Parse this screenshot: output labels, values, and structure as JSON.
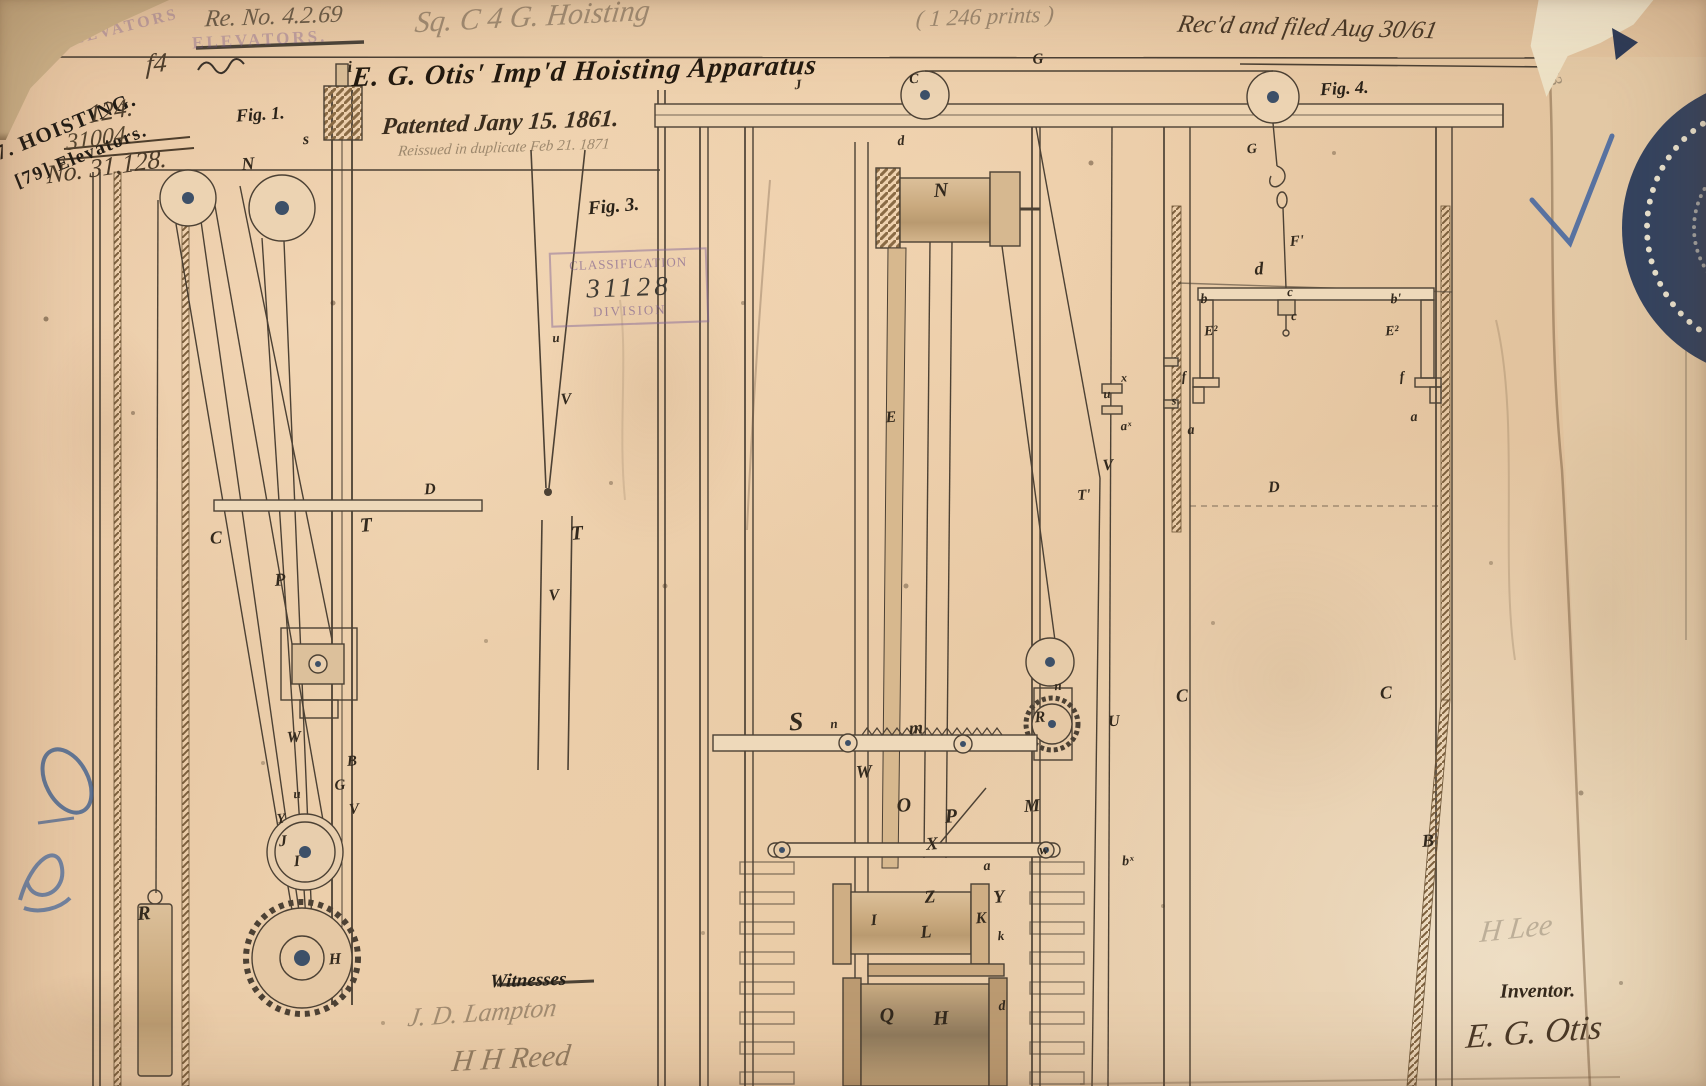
{
  "document": {
    "annotations": {
      "reissue_number": "Re. No. 4.2.69",
      "docket": "Sq. C 4 G.  Hoisting",
      "count_note": "( 1 246 prints )",
      "received_note": "Rec'd and filed Aug 30/61",
      "pencil_33": "33"
    },
    "stamps": {
      "hoisting_line1": "7. HOISTING.",
      "hoisting_line2": "[79] Elevators.",
      "ghost_1": "ELEVATORS",
      "ghost_2": "ELEVATORS.",
      "classification_top": "CLASSIFICATION",
      "classification_number": "31128",
      "classification_bottom": "DIVISION"
    },
    "case_numbers": {
      "mark_f4": "f4",
      "line1": "124.",
      "line2": "31004",
      "line3": "No. 31,128."
    },
    "title": "E. G. Otis'  Imp'd Hoisting Apparatus",
    "patented_line": "Patented Jany 15. 1861.",
    "reissued_line": "Reissued in duplicate Feb 21. 1871",
    "figure_labels": {
      "fig1": "Fig. 1.",
      "fig3": "Fig. 3.",
      "fig4": "Fig. 4."
    },
    "footer": {
      "witnesses_label": "Witnesses",
      "witness_1": "J. D. Lampton",
      "witness_2": "H H Reed",
      "pencil_signature": "H Lee",
      "inventor_label": "Inventor.",
      "inventor_signature": "E. G. Otis"
    }
  },
  "part_labels": [
    {
      "t": "i",
      "x": 350,
      "y": 68
    },
    {
      "t": "s",
      "x": 306,
      "y": 140
    },
    {
      "t": "N",
      "x": 248,
      "y": 164,
      "s": 18
    },
    {
      "t": "C",
      "x": 216,
      "y": 538,
      "s": 18
    },
    {
      "t": "P",
      "x": 280,
      "y": 580,
      "s": 18
    },
    {
      "t": "T",
      "x": 366,
      "y": 526,
      "s": 20
    },
    {
      "t": "D",
      "x": 430,
      "y": 490
    },
    {
      "t": "W",
      "x": 294,
      "y": 738
    },
    {
      "t": "B",
      "x": 352,
      "y": 762,
      "s": 15
    },
    {
      "t": "G",
      "x": 340,
      "y": 786,
      "s": 15
    },
    {
      "t": "V",
      "x": 354,
      "y": 810,
      "s": 15
    },
    {
      "t": "u",
      "x": 297,
      "y": 794,
      "s": 13
    },
    {
      "t": "Y",
      "x": 281,
      "y": 820,
      "s": 14
    },
    {
      "t": "J",
      "x": 283,
      "y": 842
    },
    {
      "t": "I",
      "x": 297,
      "y": 862
    },
    {
      "t": "R",
      "x": 144,
      "y": 914,
      "s": 20
    },
    {
      "t": "H",
      "x": 335,
      "y": 960
    },
    {
      "t": "u",
      "x": 556,
      "y": 338,
      "s": 13
    },
    {
      "t": "V",
      "x": 566,
      "y": 400
    },
    {
      "t": "T",
      "x": 577,
      "y": 534,
      "s": 20
    },
    {
      "t": "V",
      "x": 554,
      "y": 596
    },
    {
      "t": "J",
      "x": 798,
      "y": 86,
      "s": 14
    },
    {
      "t": "C",
      "x": 914,
      "y": 80,
      "s": 14
    },
    {
      "t": "G",
      "x": 1038,
      "y": 60,
      "s": 15
    },
    {
      "t": "d",
      "x": 901,
      "y": 142,
      "s": 14
    },
    {
      "t": "N",
      "x": 941,
      "y": 191,
      "s": 20
    },
    {
      "t": "E",
      "x": 891,
      "y": 418
    },
    {
      "t": "u",
      "x": 1107,
      "y": 394,
      "s": 13
    },
    {
      "t": "x",
      "x": 1124,
      "y": 378,
      "s": 12
    },
    {
      "t": "aˣ",
      "x": 1126,
      "y": 426,
      "s": 13
    },
    {
      "t": "V",
      "x": 1108,
      "y": 466
    },
    {
      "t": "T'",
      "x": 1084,
      "y": 496,
      "s": 15
    },
    {
      "t": "n",
      "x": 1058,
      "y": 686,
      "s": 13
    },
    {
      "t": "R",
      "x": 1040,
      "y": 718
    },
    {
      "t": "S",
      "x": 796,
      "y": 722,
      "s": 26
    },
    {
      "t": "n",
      "x": 834,
      "y": 724,
      "s": 13
    },
    {
      "t": "m",
      "x": 916,
      "y": 728,
      "s": 18
    },
    {
      "t": "W",
      "x": 864,
      "y": 772,
      "s": 18
    },
    {
      "t": "O",
      "x": 904,
      "y": 806,
      "s": 20
    },
    {
      "t": "M",
      "x": 1032,
      "y": 806,
      "s": 18
    },
    {
      "t": "P",
      "x": 951,
      "y": 817,
      "s": 20
    },
    {
      "t": "X",
      "x": 932,
      "y": 844,
      "s": 18
    },
    {
      "t": "w",
      "x": 1044,
      "y": 851,
      "s": 14
    },
    {
      "t": "a",
      "x": 987,
      "y": 867,
      "s": 14
    },
    {
      "t": "Z",
      "x": 930,
      "y": 897,
      "s": 18
    },
    {
      "t": "Y",
      "x": 999,
      "y": 897,
      "s": 18
    },
    {
      "t": "K",
      "x": 981,
      "y": 919
    },
    {
      "t": "k",
      "x": 1001,
      "y": 936,
      "s": 13
    },
    {
      "t": "I",
      "x": 874,
      "y": 921
    },
    {
      "t": "L",
      "x": 926,
      "y": 932,
      "s": 18
    },
    {
      "t": "Q",
      "x": 887,
      "y": 1016,
      "s": 20
    },
    {
      "t": "H",
      "x": 941,
      "y": 1019,
      "s": 20
    },
    {
      "t": "d",
      "x": 1002,
      "y": 1007,
      "s": 14
    },
    {
      "t": "U",
      "x": 1114,
      "y": 722
    },
    {
      "t": "bˣ",
      "x": 1128,
      "y": 862,
      "s": 14
    },
    {
      "t": "G",
      "x": 1252,
      "y": 150,
      "s": 14
    },
    {
      "t": "F'",
      "x": 1297,
      "y": 242,
      "s": 15
    },
    {
      "t": "d",
      "x": 1259,
      "y": 269,
      "s": 18
    },
    {
      "t": "b",
      "x": 1204,
      "y": 300,
      "s": 14
    },
    {
      "t": "c",
      "x": 1290,
      "y": 292,
      "s": 13
    },
    {
      "t": "c",
      "x": 1294,
      "y": 316,
      "s": 13
    },
    {
      "t": "b'",
      "x": 1396,
      "y": 300,
      "s": 14
    },
    {
      "t": "E²",
      "x": 1211,
      "y": 332,
      "s": 14
    },
    {
      "t": "E²",
      "x": 1392,
      "y": 332,
      "s": 14
    },
    {
      "t": "f",
      "x": 1184,
      "y": 378,
      "s": 14
    },
    {
      "t": "f",
      "x": 1402,
      "y": 378,
      "s": 14
    },
    {
      "t": "s",
      "x": 1174,
      "y": 401,
      "s": 12
    },
    {
      "t": "a",
      "x": 1191,
      "y": 431,
      "s": 14
    },
    {
      "t": "a",
      "x": 1414,
      "y": 418,
      "s": 14
    },
    {
      "t": "D",
      "x": 1274,
      "y": 488
    },
    {
      "t": "C",
      "x": 1182,
      "y": 696,
      "s": 18
    },
    {
      "t": "C",
      "x": 1386,
      "y": 693,
      "s": 18
    },
    {
      "t": "B",
      "x": 1428,
      "y": 841,
      "s": 18
    }
  ]
}
